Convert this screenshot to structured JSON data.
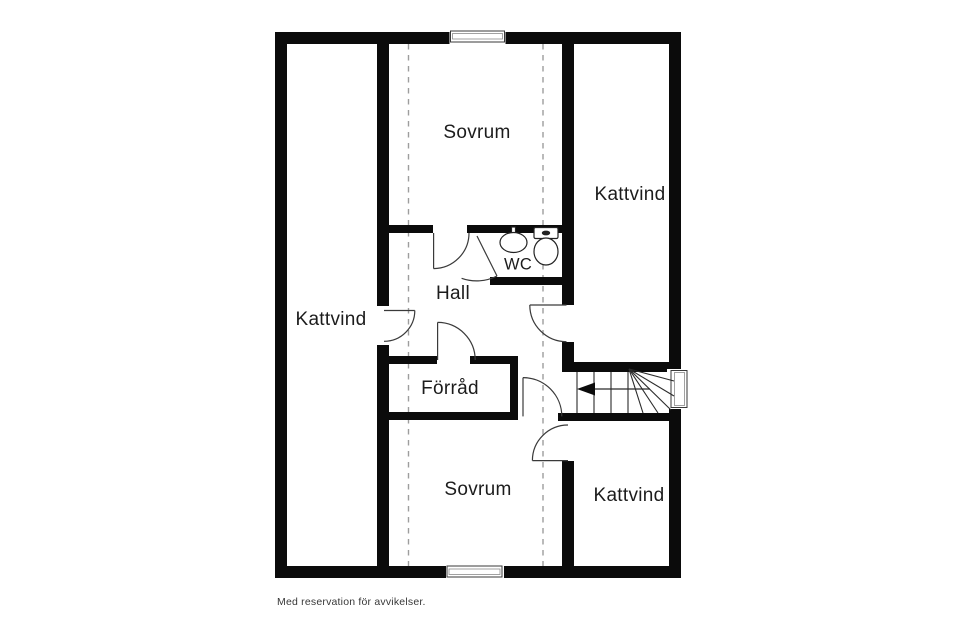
{
  "rooms": {
    "sovrum_top": {
      "label": "Sovrum"
    },
    "kattvind_top_right": {
      "label": "Kattvind"
    },
    "kattvind_left": {
      "label": "Kattvind"
    },
    "hall": {
      "label": "Hall"
    },
    "wc": {
      "label": "WC"
    },
    "forrad": {
      "label": "Förråd"
    },
    "sovrum_bottom": {
      "label": "Sovrum"
    },
    "kattvind_bottom_right": {
      "label": "Kattvind"
    }
  },
  "footer": {
    "disclaimer": "Med reservation för avvikelser."
  },
  "fixtures": {
    "sink": "sink-icon",
    "toilet": "toilet-icon"
  },
  "stairs": {
    "arrow_direction": "left"
  },
  "colors": {
    "wall": "#0b0b0b",
    "background": "#ffffff",
    "dashed_ceiling_line": "#9d9d9d",
    "door_swing": "#3a3a3a",
    "text": "#1c1c1c"
  }
}
